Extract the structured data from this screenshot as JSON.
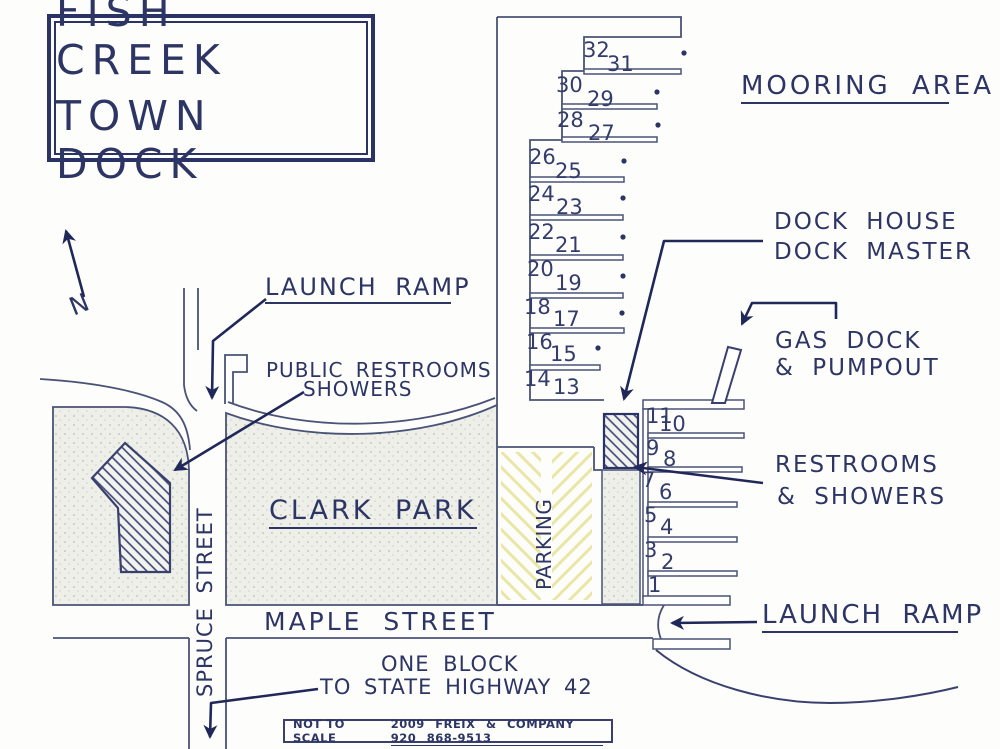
{
  "title": {
    "line1": "FISH CREEK",
    "line2": "TOWN DOCK"
  },
  "compass": {
    "north_label": "N"
  },
  "labels": {
    "mooring_area": "MOORING AREA",
    "dock_house_line1": "DOCK HOUSE",
    "dock_house_line2": "DOCK MASTER",
    "gas_dock_line1": "GAS DOCK",
    "gas_dock_line2": "& PUMPOUT",
    "restrooms_line1": "RESTROOMS",
    "restrooms_line2": "& SHOWERS",
    "launch_ramp_top": "LAUNCH RAMP",
    "launch_ramp_bottom": "LAUNCH RAMP",
    "public_restrooms_line1": "PUBLIC RESTROOMS",
    "public_restrooms_line2": "SHOWERS",
    "clark_park": "CLARK PARK",
    "parking": "PARKING",
    "spruce_street": "SPRUCE STREET",
    "maple_street": "MAPLE STREET",
    "one_block_line1": "ONE BLOCK",
    "one_block_line2": "TO STATE HIGHWAY 42"
  },
  "footer": {
    "not_to_scale": "NOT TO SCALE",
    "credit": "2009 FREIX & COMPANY 920 868-9513"
  },
  "colors": {
    "ink": "#2d3564",
    "line": "#4a5377",
    "arrow": "#20285a",
    "stipple_bg": "#edefe8",
    "stipple_dot": "#b9c3b0",
    "parking_hatch": "#e9e6a6"
  },
  "slips": [
    {
      "n": "1",
      "x": 648,
      "y": 573
    },
    {
      "n": "2",
      "x": 661,
      "y": 550
    },
    {
      "n": "3",
      "x": 644,
      "y": 538
    },
    {
      "n": "4",
      "x": 660,
      "y": 515
    },
    {
      "n": "5",
      "x": 644,
      "y": 503
    },
    {
      "n": "6",
      "x": 659,
      "y": 480
    },
    {
      "n": "7",
      "x": 642,
      "y": 468
    },
    {
      "n": "8",
      "x": 663,
      "y": 447
    },
    {
      "n": "9",
      "x": 646,
      "y": 436
    },
    {
      "n": "10",
      "x": 659,
      "y": 412
    },
    {
      "n": "11",
      "x": 646,
      "y": 404
    },
    {
      "n": "13",
      "x": 553,
      "y": 375
    },
    {
      "n": "14",
      "x": 524,
      "y": 367
    },
    {
      "n": "15",
      "x": 550,
      "y": 342
    },
    {
      "n": "16",
      "x": 526,
      "y": 330
    },
    {
      "n": "17",
      "x": 553,
      "y": 307
    },
    {
      "n": "18",
      "x": 524,
      "y": 295
    },
    {
      "n": "19",
      "x": 555,
      "y": 271
    },
    {
      "n": "20",
      "x": 527,
      "y": 257
    },
    {
      "n": "21",
      "x": 555,
      "y": 233
    },
    {
      "n": "22",
      "x": 528,
      "y": 220
    },
    {
      "n": "23",
      "x": 556,
      "y": 195
    },
    {
      "n": "24",
      "x": 528,
      "y": 182
    },
    {
      "n": "25",
      "x": 555,
      "y": 159
    },
    {
      "n": "26",
      "x": 529,
      "y": 145
    },
    {
      "n": "27",
      "x": 588,
      "y": 121
    },
    {
      "n": "28",
      "x": 557,
      "y": 108
    },
    {
      "n": "29",
      "x": 587,
      "y": 87
    },
    {
      "n": "30",
      "x": 556,
      "y": 73
    },
    {
      "n": "31",
      "x": 607,
      "y": 52
    },
    {
      "n": "32",
      "x": 583,
      "y": 38
    }
  ]
}
